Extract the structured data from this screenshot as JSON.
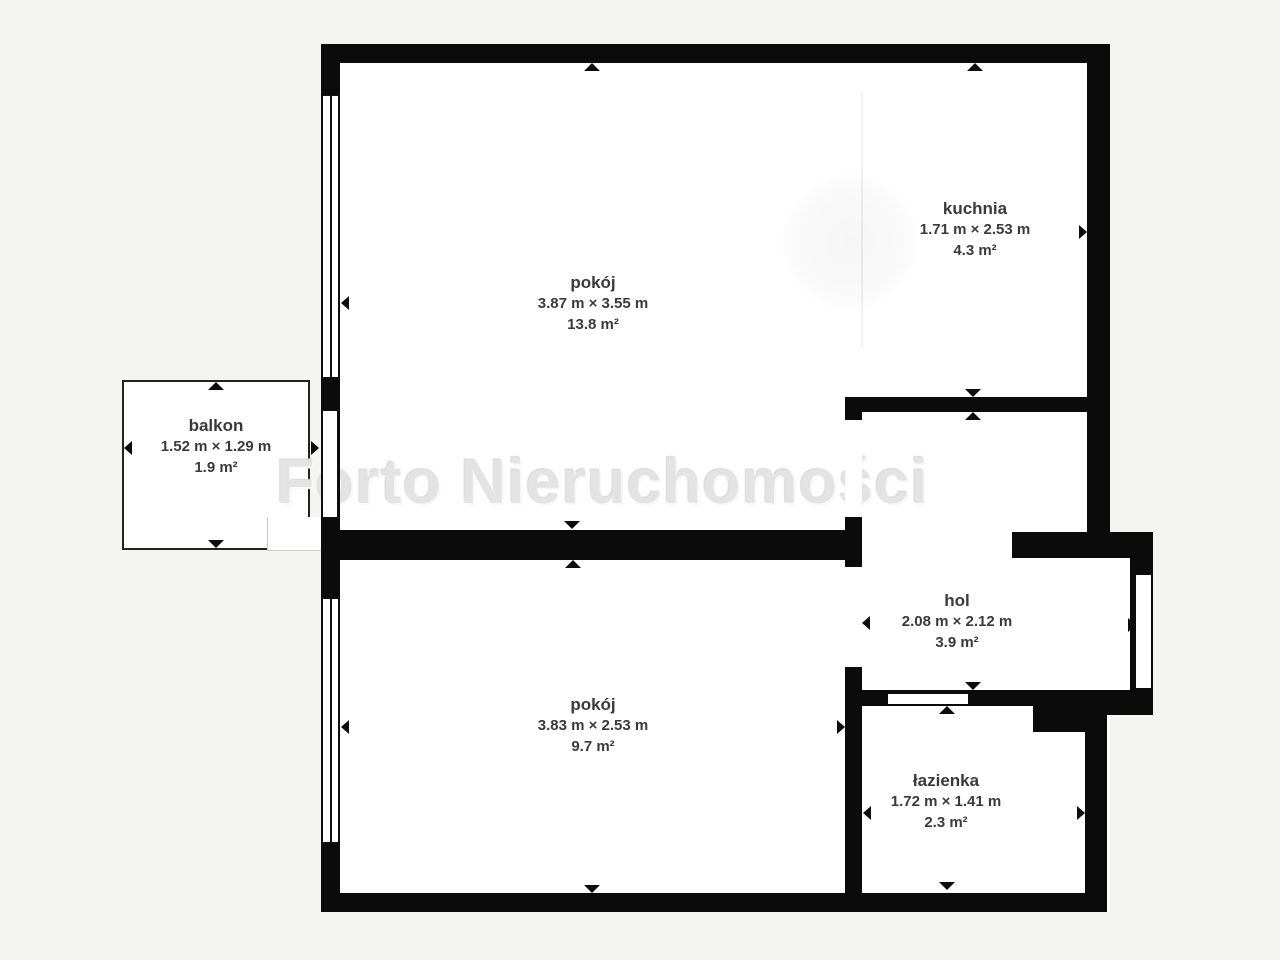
{
  "watermark": {
    "text": "Forto Nieruchomości"
  },
  "rooms": [
    {
      "id": "pokoj-top",
      "name": "pokój",
      "dimensions": "3.87 m × 3.55 m",
      "area": "13.8 m²"
    },
    {
      "id": "kuchnia",
      "name": "kuchnia",
      "dimensions": "1.71 m × 2.53 m",
      "area": "4.3 m²"
    },
    {
      "id": "balkon",
      "name": "balkon",
      "dimensions": "1.52 m × 1.29 m",
      "area": "1.9 m²"
    },
    {
      "id": "hol",
      "name": "hol",
      "dimensions": "2.08 m × 2.12 m",
      "area": "3.9 m²"
    },
    {
      "id": "pokoj-bottom",
      "name": "pokój",
      "dimensions": "3.83 m × 2.53 m",
      "area": "9.7 m²"
    },
    {
      "id": "lazienka",
      "name": "łazienka",
      "dimensions": "1.72 m × 1.41 m",
      "area": "2.3 m²"
    }
  ],
  "colors": {
    "background": "#f4f4f2",
    "wall": "#0b0b0b",
    "floor": "#ffffff",
    "label_text": "#3a3a3a",
    "watermark_text": "#e3e3e3"
  }
}
